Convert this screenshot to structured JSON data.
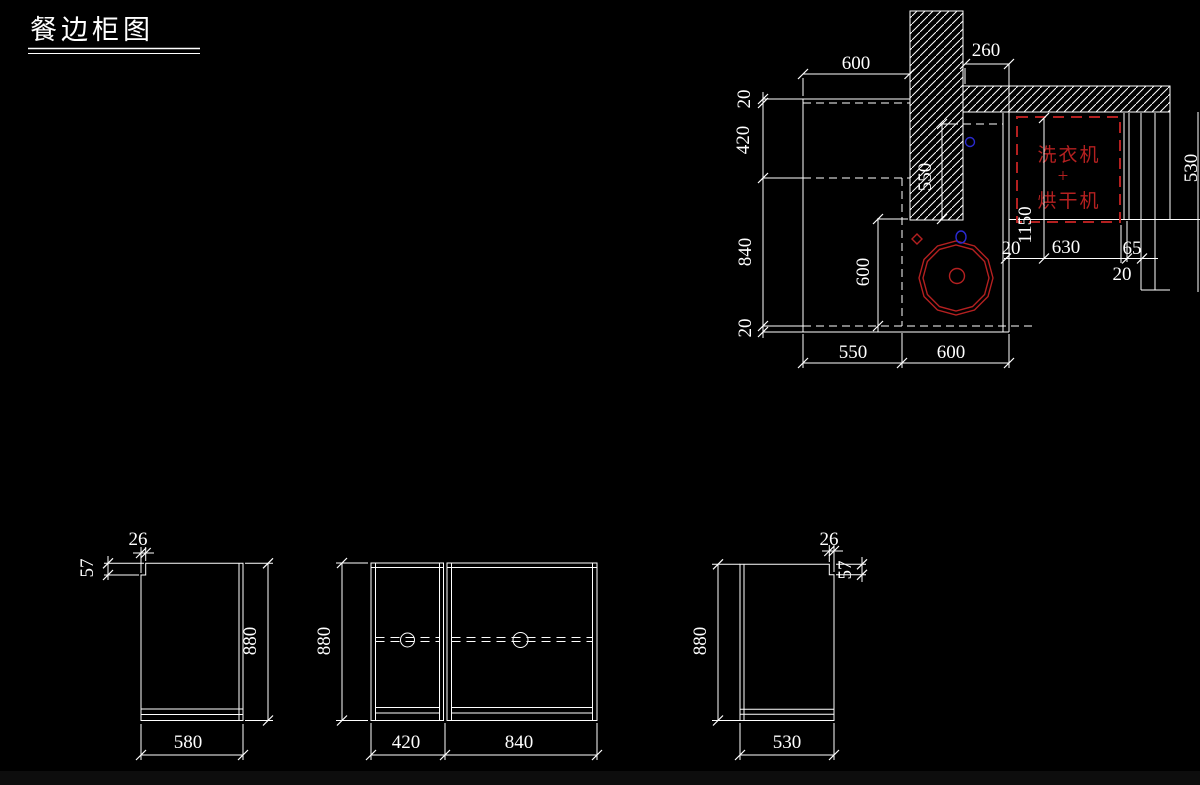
{
  "title": {
    "text": "餐边柜图"
  },
  "plan": {
    "dim_top_width": "600",
    "dim_wall_right": "260",
    "dim_left_top_gap": "20",
    "dim_left_upper_depth": "420",
    "dim_left_lower_depth": "840",
    "dim_left_bottom_gap": "20",
    "dim_inner_depth": "600",
    "dim_wall_length": "550",
    "dim_bottom_left": "550",
    "dim_bottom_right": "600",
    "dim_right_edge_thk": "20",
    "dim_washer_height": "1150",
    "dim_washer_width": "630",
    "dim_right_65": "65",
    "dim_right_20": "20",
    "dim_edge_clipped": "530",
    "washer_label_top": "洗衣机",
    "washer_label_plus": "+",
    "washer_label_bottom": "烘干机"
  },
  "elevation_left": {
    "dim_notch_width": "26",
    "dim_notch_height": "57",
    "dim_height": "880",
    "dim_width": "580"
  },
  "elevation_middle": {
    "dim_height": "880",
    "dim_left_width": "420",
    "dim_right_width": "840"
  },
  "elevation_right": {
    "dim_notch_width": "26",
    "dim_notch_height": "57",
    "dim_height": "880",
    "dim_width": "530"
  },
  "colors": {
    "background": "#000000",
    "line": "#ffffff",
    "red": "#b42020",
    "blue": "#2a2ad0"
  }
}
